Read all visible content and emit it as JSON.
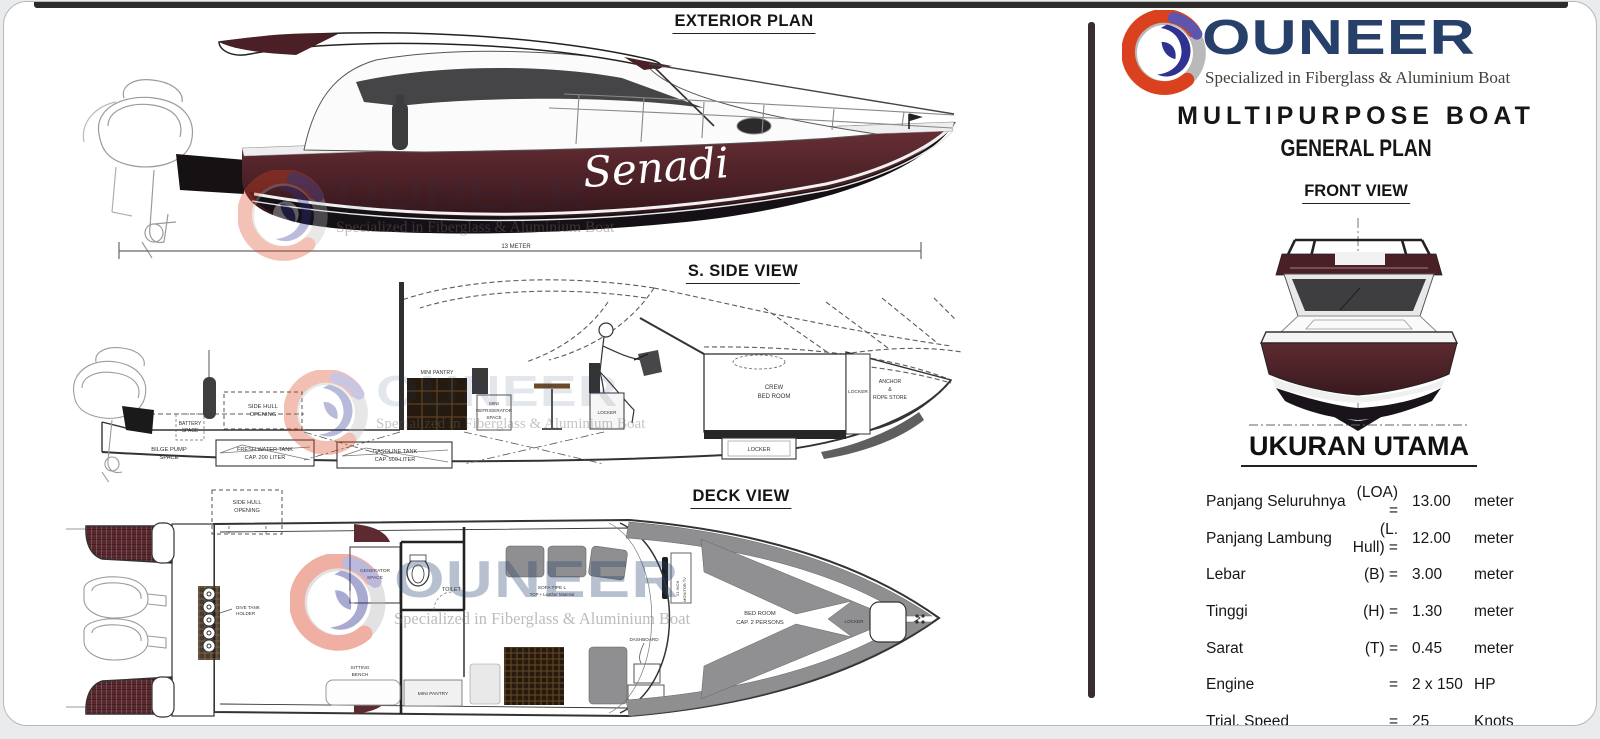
{
  "watermark": {
    "brand": "OUNEER",
    "tagline": "Specialized in Fiberglass & Aluminium Boat"
  },
  "exterior_view": {
    "title": "EXTERIOR PLAN",
    "boat_name": "Senadi",
    "dimension_label": "13 METER"
  },
  "side_view": {
    "title": "S. SIDE VIEW",
    "labels": {
      "bilge1": "BILGE PUMP",
      "bilge2": "SPACE",
      "battery1": "BATTERY",
      "battery2": "SPACE",
      "sidehull1": "SIDE HULL",
      "sidehull2": "OPENING",
      "fresh1": "FRESH WATER TANK",
      "fresh2": "CAP. 200 LITER",
      "gas1": "GASOLINE TANK",
      "gas2": "CAP. 500 LITER",
      "pantry": "MINI PANTRY",
      "fridge1": "MINI",
      "fridge2": "REFRIGERATOR",
      "fridge3": "SPACE",
      "locker_seat": "LOCKER",
      "crew1": "CREW",
      "crew2": "BED ROOM",
      "locker_aft": "LOCKER",
      "anchor1": "ANCHOR",
      "anchor2": "&",
      "anchor3": "ROPE STORE",
      "locker_bottom": "LOCKER"
    }
  },
  "deck_view": {
    "title": "DECK VIEW",
    "labels": {
      "sidehull1": "SIDE HULL",
      "sidehull2": "OPENING",
      "dive1": "DIVE TANK",
      "dive2": "HOLDER",
      "generator1": "GENERATOR",
      "generator2": "SPACE",
      "toilet": "TOILET",
      "bench1": "SITTING",
      "bench2": "BENCH",
      "pantry": "MINI PANTRY",
      "sofa1": "SOFA TIPE L",
      "sofa2": "TOP + Leather Material",
      "dashboard": "DASHBOARD",
      "monitor1": "21 INCH",
      "monitor2": "MONITOR TV",
      "bed1": "BED ROOM",
      "bed2": "CAP. 2 PERSONS",
      "locker": "LOCKER"
    }
  },
  "right_panel": {
    "logo": {
      "brand": "OUNEER",
      "tagline": "Specialized in Fiberglass & Aluminium Boat"
    },
    "title": "MULTIPURPOSE BOAT",
    "subtitle": "GENERAL PLAN",
    "front_view_title": "FRONT VIEW",
    "specs": {
      "heading": "UKURAN UTAMA",
      "rows": [
        {
          "label": "Panjang Seluruhnya",
          "symbol": "(LOA) =",
          "value": "13.00",
          "unit": "meter"
        },
        {
          "label": "Panjang Lambung",
          "symbol": "(L. Hull) =",
          "value": "12.00",
          "unit": "meter"
        },
        {
          "label": "Lebar",
          "symbol": "(B) =",
          "value": "3.00",
          "unit": "meter"
        },
        {
          "label": "Tinggi",
          "symbol": "(H) =",
          "value": "1.30",
          "unit": "meter"
        },
        {
          "label": "Sarat",
          "symbol": "(T) =",
          "value": "0.45",
          "unit": "meter"
        },
        {
          "label": "Engine",
          "symbol": "=",
          "value": "2 x 150",
          "unit": "HP"
        },
        {
          "label": "Trial. Speed",
          "symbol": "=",
          "value": "25",
          "unit": "Knots"
        }
      ]
    }
  },
  "colors": {
    "hull_maroon": "#4a2026",
    "logo_navy": "#26406a",
    "logo_red": "#d9411f",
    "logo_blue": "#2f3290"
  }
}
